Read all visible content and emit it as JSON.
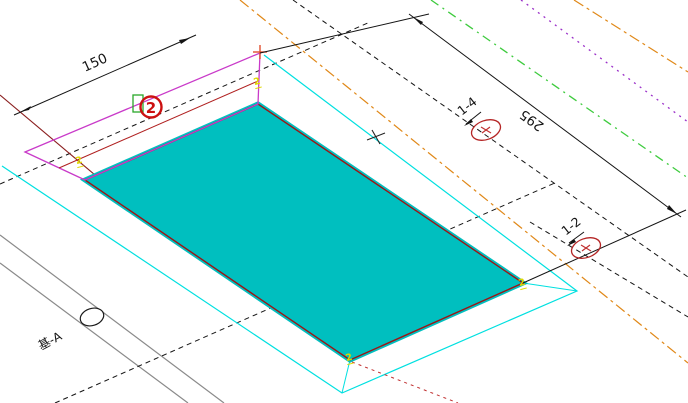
{
  "canvas": {
    "width": 688,
    "height": 403,
    "background": "#ffffff"
  },
  "labels": {
    "dim_width": "150",
    "dim_length": "295",
    "section_1": "1-4",
    "section_2": "1-2",
    "bubble_number": "2",
    "axis_name": "基-A",
    "corner_mark": "2"
  },
  "colors": {
    "panel_fill": "#00bfbf",
    "panel_edge": "#9c1515",
    "mold_outline": "#00e0e0",
    "side_form_magenta": "#c93ac9",
    "dark_red_edge": "#8b1f1f",
    "dimension_black": "#141414",
    "aux_orange": "#e08818",
    "aux_green": "#3ecb3e",
    "aux_violet": "#9b30c9",
    "section_red": "#b52626",
    "bubble_red": "#cc1111",
    "bubble_green": "#2aa82a",
    "marker_yellow": "#e0d800",
    "table_gray": "#8a8a8a"
  },
  "entities": [
    {
      "name": "table-edge-line-1",
      "kind": "line",
      "stroke": "#8a8a8a",
      "width": 1.2,
      "pts": [
        [
          0,
          235
        ],
        [
          224,
          403
        ]
      ],
      "inter": "false"
    },
    {
      "name": "table-edge-line-2",
      "kind": "line",
      "stroke": "#8a8a8a",
      "width": 1.2,
      "pts": [
        [
          0,
          263
        ],
        [
          188,
          403
        ]
      ],
      "inter": "false"
    },
    {
      "name": "aux-orange-line-1",
      "kind": "line",
      "stroke": "#e08818",
      "width": 1.2,
      "dash": "11 4 3 4",
      "pts": [
        [
          240,
          0
        ],
        [
          688,
          363
        ]
      ],
      "inter": "false"
    },
    {
      "name": "aux-orange-line-2",
      "kind": "line",
      "stroke": "#e08818",
      "width": 1.2,
      "dash": "11 4 3 4",
      "pts": [
        [
          574,
          0
        ],
        [
          688,
          72
        ]
      ],
      "inter": "false"
    },
    {
      "name": "aux-green-line",
      "kind": "line",
      "stroke": "#3ecb3e",
      "width": 1.3,
      "dash": "9 5 2 5",
      "pts": [
        [
          431,
          0
        ],
        [
          688,
          178
        ]
      ],
      "inter": "false"
    },
    {
      "name": "aux-violet-line",
      "kind": "line",
      "stroke": "#9b30c9",
      "width": 1.3,
      "dash": "2 5",
      "pts": [
        [
          521,
          0
        ],
        [
          688,
          122
        ]
      ],
      "inter": "false"
    },
    {
      "name": "centerline-strip-axis",
      "kind": "line",
      "stroke": "#141414",
      "width": 1,
      "dash": "5 4",
      "pts": [
        [
          0,
          184
        ],
        [
          370,
          22
        ]
      ],
      "inter": "false"
    },
    {
      "name": "centerline-long-axis",
      "kind": "line",
      "stroke": "#141414",
      "width": 1,
      "dash": "5 4",
      "pts": [
        [
          293,
          0
        ],
        [
          688,
          277
        ]
      ],
      "inter": "false"
    },
    {
      "name": "centerline-cross-axis",
      "kind": "line",
      "stroke": "#141414",
      "width": 1,
      "dash": "5 4",
      "pts": [
        [
          55,
          403
        ],
        [
          557,
          182
        ]
      ],
      "inter": "false"
    },
    {
      "name": "centerline-right",
      "kind": "line",
      "stroke": "#141414",
      "width": 1,
      "dash": "5 4",
      "pts": [
        [
          530,
          222
        ],
        [
          688,
          317
        ]
      ],
      "inter": "false"
    },
    {
      "name": "dark-red-edge-line",
      "kind": "line",
      "stroke": "#8b1f1f",
      "width": 1.1,
      "pts": [
        [
          0,
          95
        ],
        [
          158,
          228
        ]
      ],
      "inter": "false"
    },
    {
      "name": "mold-outline",
      "kind": "polyline",
      "stroke": "#00e0e0",
      "width": 1.2,
      "pts": [
        [
          2,
          166
        ],
        [
          342,
          393
        ],
        [
          577,
          291
        ],
        [
          264,
          55
        ]
      ],
      "inter": "true"
    },
    {
      "name": "mold-edge-bottom-corner",
      "kind": "line",
      "stroke": "#00e0e0",
      "width": 1,
      "pts": [
        [
          350,
          360
        ],
        [
          342,
          393
        ]
      ],
      "inter": "true"
    },
    {
      "name": "mold-edge-right-corner",
      "kind": "line",
      "stroke": "#00e0e0",
      "width": 1,
      "pts": [
        [
          523,
          283
        ],
        [
          577,
          291
        ]
      ],
      "inter": "true"
    },
    {
      "name": "panel-top-face",
      "kind": "polygon",
      "stroke": "#00bfbf",
      "width": 5,
      "fill": "#00bfbf",
      "pts": [
        [
          85,
          180
        ],
        [
          258,
          104
        ],
        [
          523,
          283
        ],
        [
          350,
          360
        ]
      ],
      "inter": "true"
    },
    {
      "name": "panel-top-outline",
      "kind": "polygon",
      "stroke": "#9c1515",
      "width": 1.4,
      "pts": [
        [
          85,
          180
        ],
        [
          258,
          104
        ],
        [
          523,
          283
        ],
        [
          350,
          360
        ]
      ],
      "inter": "true"
    },
    {
      "name": "panel-axis-dotted-red",
      "kind": "line",
      "stroke": "#c03030",
      "width": 1,
      "dash": "3 4",
      "pts": [
        [
          352,
          362
        ],
        [
          458,
          403
        ]
      ],
      "inter": "false"
    },
    {
      "name": "side-form-outline",
      "kind": "polygon",
      "stroke": "#c93ac9",
      "width": 1.3,
      "pts": [
        [
          25,
          152
        ],
        [
          260,
          53
        ],
        [
          258,
          104
        ],
        [
          85,
          180
        ]
      ],
      "inter": "true"
    },
    {
      "name": "side-form-inner-edge",
      "kind": "line",
      "stroke": "#b02020",
      "width": 1,
      "pts": [
        [
          59,
          168
        ],
        [
          258,
          81
        ]
      ],
      "inter": "true"
    },
    {
      "name": "corner-cross-red-h",
      "kind": "line",
      "stroke": "#e05030",
      "width": 1.4,
      "pts": [
        [
          253,
          52
        ],
        [
          267,
          52
        ]
      ],
      "inter": "false"
    },
    {
      "name": "corner-cross-red-v",
      "kind": "line",
      "stroke": "#e05030",
      "width": 1.4,
      "pts": [
        [
          260,
          45
        ],
        [
          260,
          59
        ]
      ],
      "inter": "false"
    },
    {
      "name": "center-mark-cross-a",
      "kind": "line",
      "stroke": "#222222",
      "width": 1.1,
      "pts": [
        [
          367,
          140
        ],
        [
          385,
          133
        ]
      ],
      "inter": "false"
    },
    {
      "name": "center-mark-cross-b",
      "kind": "line",
      "stroke": "#222222",
      "width": 1.1,
      "pts": [
        [
          372,
          130
        ],
        [
          380,
          144
        ]
      ],
      "inter": "false"
    },
    {
      "name": "dim-150-line",
      "kind": "line",
      "stroke": "#141414",
      "width": 1,
      "pts": [
        [
          14,
          115
        ],
        [
          196,
          35
        ]
      ],
      "inter": "true"
    },
    {
      "name": "dim-150-arrow-left",
      "kind": "polygon",
      "fill": "#141414",
      "pts": [
        [
          20,
          112
        ],
        [
          31,
          106
        ],
        [
          29,
          110
        ]
      ],
      "inter": "true"
    },
    {
      "name": "dim-150-arrow-right",
      "kind": "polygon",
      "fill": "#141414",
      "pts": [
        [
          190,
          38
        ],
        [
          179,
          40
        ],
        [
          181,
          44
        ]
      ],
      "inter": "true"
    },
    {
      "name": "dim-295-ext-top",
      "kind": "line",
      "stroke": "#141414",
      "width": 1,
      "pts": [
        [
          260,
          53
        ],
        [
          429,
          14
        ]
      ],
      "inter": "true"
    },
    {
      "name": "dim-295-ext-bottom",
      "kind": "line",
      "stroke": "#141414",
      "width": 1,
      "pts": [
        [
          523,
          283
        ],
        [
          686,
          210
        ]
      ],
      "inter": "true"
    },
    {
      "name": "dim-295-line",
      "kind": "line",
      "stroke": "#141414",
      "width": 1,
      "pts": [
        [
          409,
          14
        ],
        [
          681,
          217
        ]
      ],
      "inter": "true"
    },
    {
      "name": "dim-295-arrow-top",
      "kind": "polygon",
      "fill": "#141414",
      "pts": [
        [
          413,
          17
        ],
        [
          421,
          25
        ],
        [
          423,
          22
        ]
      ],
      "inter": "true"
    },
    {
      "name": "dim-295-arrow-bottom",
      "kind": "polygon",
      "fill": "#141414",
      "pts": [
        [
          677,
          214
        ],
        [
          667,
          209
        ],
        [
          669,
          205
        ]
      ],
      "inter": "true"
    },
    {
      "name": "section-1-4-circle",
      "kind": "ellipse",
      "cx": 486,
      "cy": 130,
      "rx": 15,
      "ry": 9.5,
      "rot": -20,
      "stroke": "#b52626",
      "width": 1.3,
      "inter": "true"
    },
    {
      "name": "section-1-4-x-a",
      "kind": "line",
      "stroke": "#c03030",
      "width": 1.2,
      "pts": [
        [
          481,
          127
        ],
        [
          491,
          133
        ]
      ],
      "inter": "false"
    },
    {
      "name": "section-1-4-x-b",
      "kind": "line",
      "stroke": "#c03030",
      "width": 1.2,
      "pts": [
        [
          482,
          133
        ],
        [
          490,
          127
        ]
      ],
      "inter": "false"
    },
    {
      "name": "section-1-2-circle",
      "kind": "ellipse",
      "cx": 586,
      "cy": 248,
      "rx": 15,
      "ry": 9.5,
      "rot": -20,
      "stroke": "#b52626",
      "width": 1.3,
      "inter": "true"
    },
    {
      "name": "section-1-2-x-a",
      "kind": "line",
      "stroke": "#c03030",
      "width": 1.2,
      "pts": [
        [
          581,
          245
        ],
        [
          591,
          251
        ]
      ],
      "inter": "false"
    },
    {
      "name": "section-1-2-x-b",
      "kind": "line",
      "stroke": "#c03030",
      "width": 1.2,
      "pts": [
        [
          582,
          251
        ],
        [
          590,
          245
        ]
      ],
      "inter": "false"
    },
    {
      "name": "section-1-4-leader",
      "kind": "line",
      "stroke": "#141414",
      "width": 1,
      "pts": [
        [
          481,
          112
        ],
        [
          466,
          124
        ]
      ],
      "inter": "true"
    },
    {
      "name": "section-1-4-leader-arrow",
      "kind": "polygon",
      "fill": "#141414",
      "pts": [
        [
          464,
          126
        ],
        [
          471,
          119
        ],
        [
          473,
          122
        ]
      ],
      "inter": "true"
    },
    {
      "name": "section-1-2-leader",
      "kind": "line",
      "stroke": "#141414",
      "width": 1,
      "pts": [
        [
          584,
          232
        ],
        [
          569,
          243
        ]
      ],
      "inter": "true"
    },
    {
      "name": "section-1-2-leader-arrow",
      "kind": "polygon",
      "fill": "#141414",
      "pts": [
        [
          567,
          246
        ],
        [
          574,
          239
        ],
        [
          576,
          242
        ]
      ],
      "inter": "true"
    },
    {
      "name": "part-bubble-green-box",
      "kind": "rect",
      "x": 133,
      "y": 95,
      "w": 10,
      "h": 17,
      "stroke": "#2aa82a",
      "width": 1.3,
      "inter": "true"
    },
    {
      "name": "part-bubble-circle",
      "kind": "ellipse",
      "cx": 151,
      "cy": 107,
      "rx": 10.5,
      "ry": 10.5,
      "rot": 0,
      "stroke": "#cc1111",
      "width": 2.4,
      "inter": "true"
    },
    {
      "name": "axis-bubble",
      "kind": "ellipse",
      "cx": 92,
      "cy": 317,
      "rx": 12,
      "ry": 8.5,
      "rot": -18,
      "stroke": "#1a1a1a",
      "width": 1.2,
      "fill": "#ffffff",
      "inter": "true"
    }
  ],
  "texts": [
    {
      "name": "dim-150-text",
      "bind": "labels.dim_width",
      "x": 95,
      "y": 63,
      "rot": -24.5,
      "size": 13.5,
      "color": "#141414",
      "inter": "true"
    },
    {
      "name": "dim-295-text",
      "bind": "labels.dim_length",
      "x": 532,
      "y": 120,
      "rot": 216,
      "size": 13.5,
      "color": "#141414",
      "inter": "true"
    },
    {
      "name": "section-1-4-label",
      "bind": "labels.section_1",
      "x": 467,
      "y": 106,
      "rot": -38,
      "size": 12.5,
      "color": "#141414",
      "inter": "true"
    },
    {
      "name": "section-1-2-label",
      "bind": "labels.section_2",
      "x": 571,
      "y": 226,
      "rot": -38,
      "size": 12.5,
      "color": "#141414",
      "inter": "true"
    },
    {
      "name": "part-bubble-number",
      "bind": "labels.bubble_number",
      "x": 151,
      "y": 108,
      "rot": 0,
      "size": 15,
      "color": "#cc1111",
      "weight": "bold",
      "inter": "true"
    },
    {
      "name": "axis-label",
      "bind": "labels.axis_name",
      "x": 50,
      "y": 341,
      "rot": -28,
      "size": 12,
      "color": "#141414",
      "inter": "true"
    },
    {
      "name": "corner-mark-top",
      "bind": "labels.corner_mark",
      "x": 257,
      "y": 82,
      "rot": -15,
      "size": 9.5,
      "color": "#e0d800",
      "weight": "bold",
      "underline": true,
      "inter": "false"
    },
    {
      "name": "corner-mark-left",
      "bind": "labels.corner_mark",
      "x": 79,
      "y": 161,
      "rot": -15,
      "size": 9.5,
      "color": "#e0d800",
      "weight": "bold",
      "underline": true,
      "inter": "false"
    },
    {
      "name": "corner-mark-bottom",
      "bind": "labels.corner_mark",
      "x": 349,
      "y": 358,
      "rot": -15,
      "size": 9.5,
      "color": "#e0d800",
      "weight": "bold",
      "underline": true,
      "inter": "false"
    },
    {
      "name": "corner-mark-right",
      "bind": "labels.corner_mark",
      "x": 522,
      "y": 283,
      "rot": -15,
      "size": 9.5,
      "color": "#e0d800",
      "weight": "bold",
      "underline": true,
      "inter": "false"
    }
  ]
}
